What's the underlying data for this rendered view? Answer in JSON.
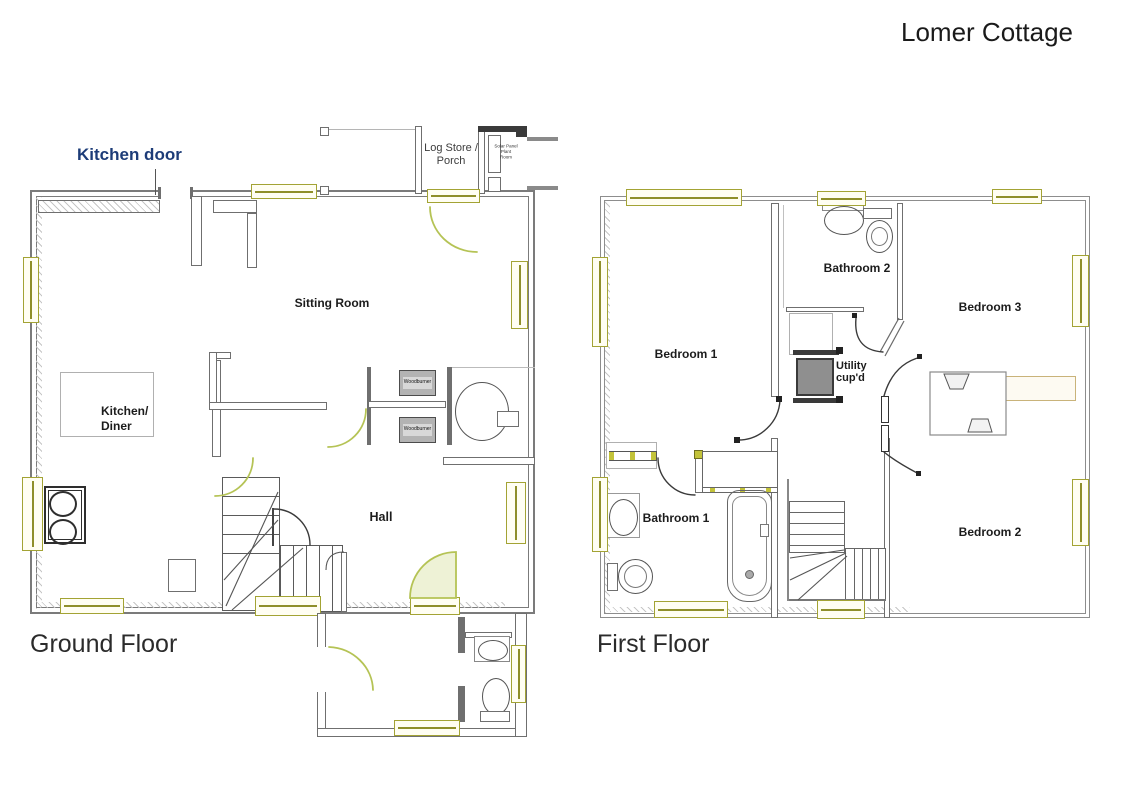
{
  "title": "Lomer Cottage",
  "annotations": {
    "kitchen_door": "Kitchen door"
  },
  "colors": {
    "wall": "#7b7b7b",
    "window": "#a3a334",
    "door_arc": "#b5c355",
    "annotation_blue": "#1d3c78"
  },
  "ground_floor": {
    "label": "Ground Floor",
    "rooms": {
      "sitting_room": "Sitting Room",
      "kitchen_diner": "Kitchen/\nDiner",
      "hall": "Hall",
      "log_store": "Log Store /\nPorch",
      "solar_room": "Solar Panel\nPlant\nRoom"
    },
    "fixtures": {
      "woodburner": "Woodburner"
    }
  },
  "first_floor": {
    "label": "First Floor",
    "rooms": {
      "bedroom1": "Bedroom 1",
      "bedroom2": "Bedroom 2",
      "bedroom3": "Bedroom 3",
      "bathroom1": "Bathroom 1",
      "bathroom2": "Bathroom 2",
      "utility": "Utility\ncup'd"
    }
  }
}
